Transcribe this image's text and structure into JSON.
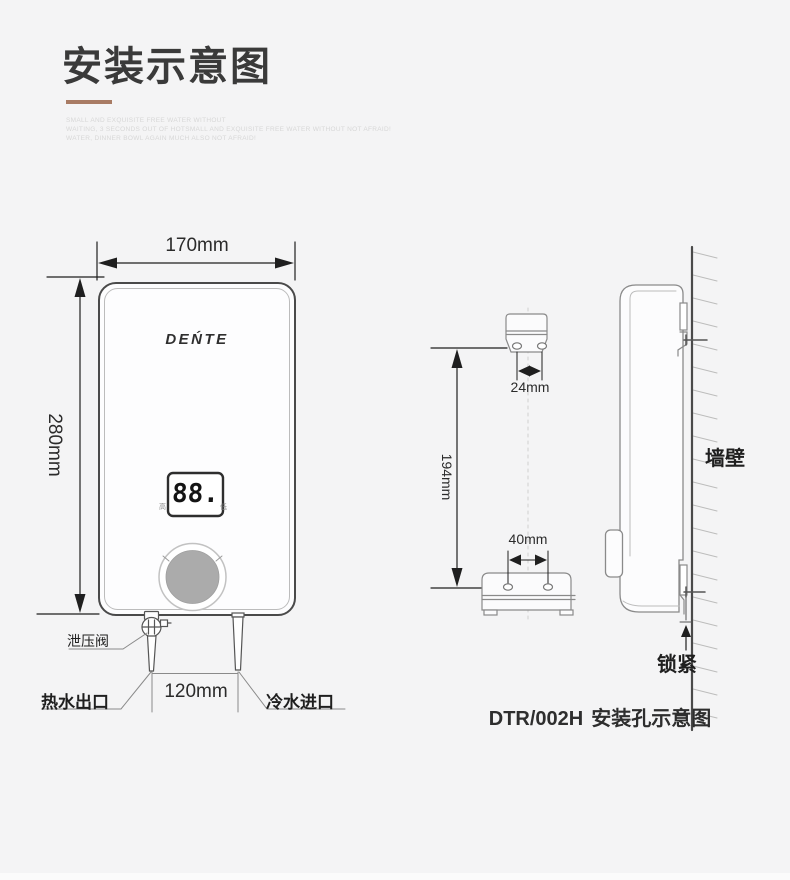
{
  "page": {
    "background": "#f4f4f5",
    "accent_color": "#a87b64"
  },
  "header": {
    "title": "安装示意图",
    "subtitle_lines": [
      "SMALL AND EXQUISITE FREE WATER WITHOUT",
      "WAITING, 3 SECONDS OUT OF HOTSMALL AND EXQUISITE FREE WATER WITHOUT NOT AFRAID!",
      "WATER, DINNER BOWL AGAIN MUCH ALSO NOT AFRAID!"
    ]
  },
  "front_view": {
    "brand": "DEŃTE",
    "display_value": "88.",
    "knob_left_label": "高",
    "knob_right_label": "低",
    "dim_width": "170mm",
    "dim_height": "280mm",
    "dim_pipe_spacing": "120mm",
    "label_relief_valve": "泄压阀",
    "label_hot_outlet": "热水出口",
    "label_cold_inlet": "冷水进口"
  },
  "hole_view": {
    "dim_top_holes": "24mm",
    "dim_vertical": "194mm",
    "dim_bottom_holes": "40mm"
  },
  "side_view": {
    "label_wall": "墙壁",
    "label_lock": "锁紧"
  },
  "caption": {
    "model": "DTR/002H",
    "text": "安装孔示意图"
  }
}
